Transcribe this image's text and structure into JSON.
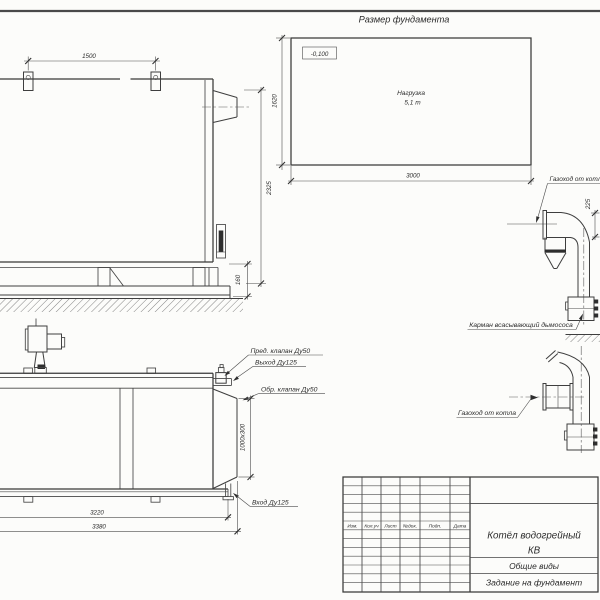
{
  "side_view": {
    "dim_lug_spacing": "1500",
    "dim_height": "2325",
    "dim_base_height": "160"
  },
  "foundation_plan": {
    "title": "Размер фундамента",
    "elevation_mark": "-0,100",
    "load_line1": "Нагрузка",
    "load_line2": "5,1 т",
    "dim_length": "3000",
    "dim_width": "1620"
  },
  "duct_view_upper": {
    "duct_label": "Газоход от котла",
    "dim_offset": "225",
    "pocket_label": "Карман всасывающий дымососа"
  },
  "duct_view_lower": {
    "duct_label": "Газоход от котла"
  },
  "front_view": {
    "label_safety_valve": "Пред. клапан Ду50",
    "label_outlet": "Выход Ду125",
    "label_check_valve": "Обр. клапан Ду50",
    "label_inlet": "Вход Ду125",
    "dim_duct_section": "1000х300",
    "dim_length_inner": "3220",
    "dim_length_overall": "3380"
  },
  "title_block": {
    "columns": [
      "Изм.",
      "Кол.уч",
      "Лист",
      "№док.",
      "Подп.",
      "Дата"
    ],
    "product_line1": "Котёл водогрейный",
    "product_line2": "КВ",
    "doc_line1": "Общие виды",
    "doc_line2": "Задание на фундамент"
  }
}
